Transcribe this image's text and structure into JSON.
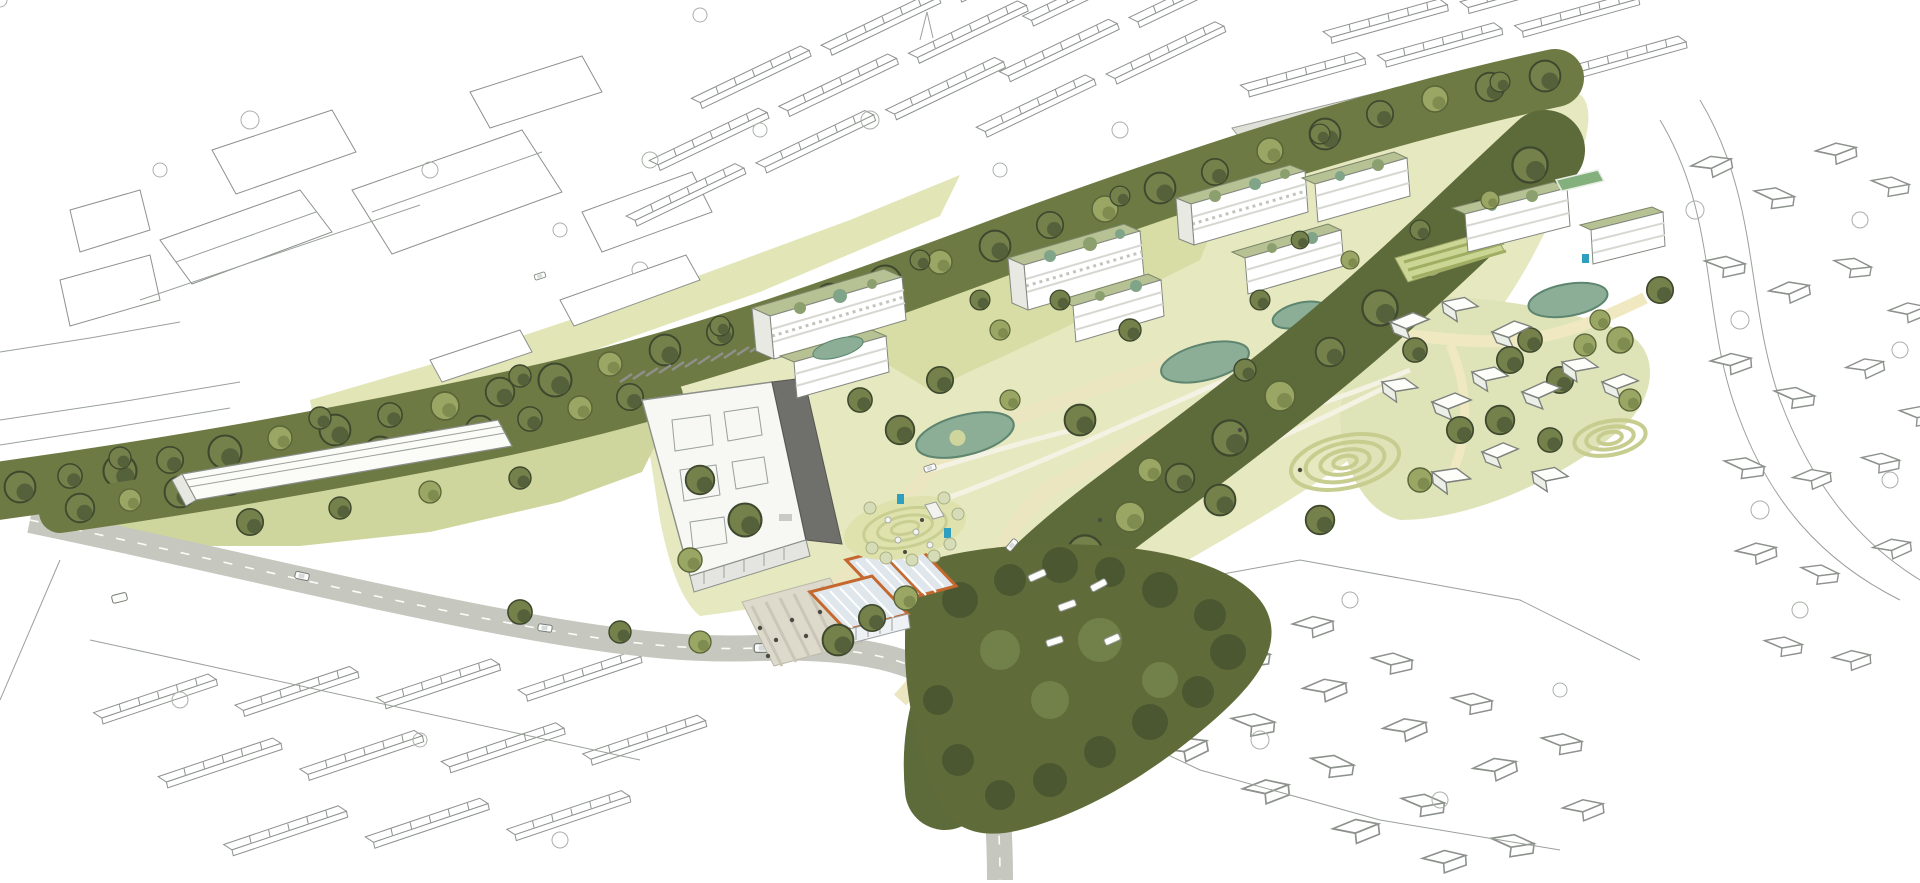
{
  "image": {
    "kind": "hand-drawn aerial masterplan illustration",
    "width": 1920,
    "height": 883,
    "description": "Aerial perspective sketch of a neighbourhood masterplan: white apartment blocks with green roofs set in a linear park with ponds and mown-lawn features, a tree-lined railway corridor crossing diagonally, a long white shed and tall slab building with dark core, an orange-framed glazed pavilion on a plaza, play areas, dense woodland, and surrounding existing streets rendered as uncoloured line art."
  },
  "palette": {
    "background": "#ffffff",
    "line_art_stroke": "#8d928d",
    "tree_dark": "#55613a",
    "tree_mid": "#75814a",
    "tree_light": "#9aa663",
    "sapling_pale": "#d7dcb8",
    "meadow_pale": "#e6e8c0",
    "lawn_green": "#cfd69d",
    "mown_ring": "#c6cd8f",
    "pond_teal": "#8cae96",
    "pond_edge": "#5e8570",
    "road_grey": "#c6c7bf",
    "rail_grey": "#b9bbb2",
    "path_cream": "#ebe5c0",
    "plaza_grey": "#ddd9cb",
    "building_white": "#ffffff",
    "building_side": "#e8e9e2",
    "green_roof": "#b6c194",
    "dark_core_grey": "#6f706c",
    "pavilion_orange": "#c4682e",
    "glazing_blue": "#dfe7ec",
    "play_equipment_blue": "#2f9fc0",
    "sports_court_green": "#83b07c"
  },
  "scene": {
    "elements": [
      {
        "name": "context-line-art",
        "note": "existing terraces, industrial sheds and suburbs drawn as outline only"
      },
      {
        "name": "railway-tree-corridor",
        "note": "dense olive tree belt with grey track and platform"
      },
      {
        "name": "central-park",
        "note": "pale meadow, cream greenway paths, teal ponds, mown-ring lawn features"
      },
      {
        "name": "apartment-clusters",
        "note": "white perimeter blocks with planted green roofs and courtyards"
      },
      {
        "name": "allotment-garden",
        "note": "striped cultivation beds"
      },
      {
        "name": "long-shed-building",
        "note": "long white industrial shed on lawn"
      },
      {
        "name": "slab-building",
        "note": "tall white slab with dark grey service core and parking rows"
      },
      {
        "name": "orange-pavilion",
        "note": "glazed sawtooth-roof pavilion with orange frame on striped plaza"
      },
      {
        "name": "play-area",
        "note": "slide, boulders, blue equipment, pale saplings"
      },
      {
        "name": "woodland",
        "note": "dark tree mass with caravans and greenway"
      },
      {
        "name": "main-road",
        "note": "grey road with cars, bus stop and street trees"
      },
      {
        "name": "sports-court",
        "note": "small green court"
      },
      {
        "name": "bridge",
        "note": "line-art road bridge over corridor at far left"
      }
    ]
  }
}
